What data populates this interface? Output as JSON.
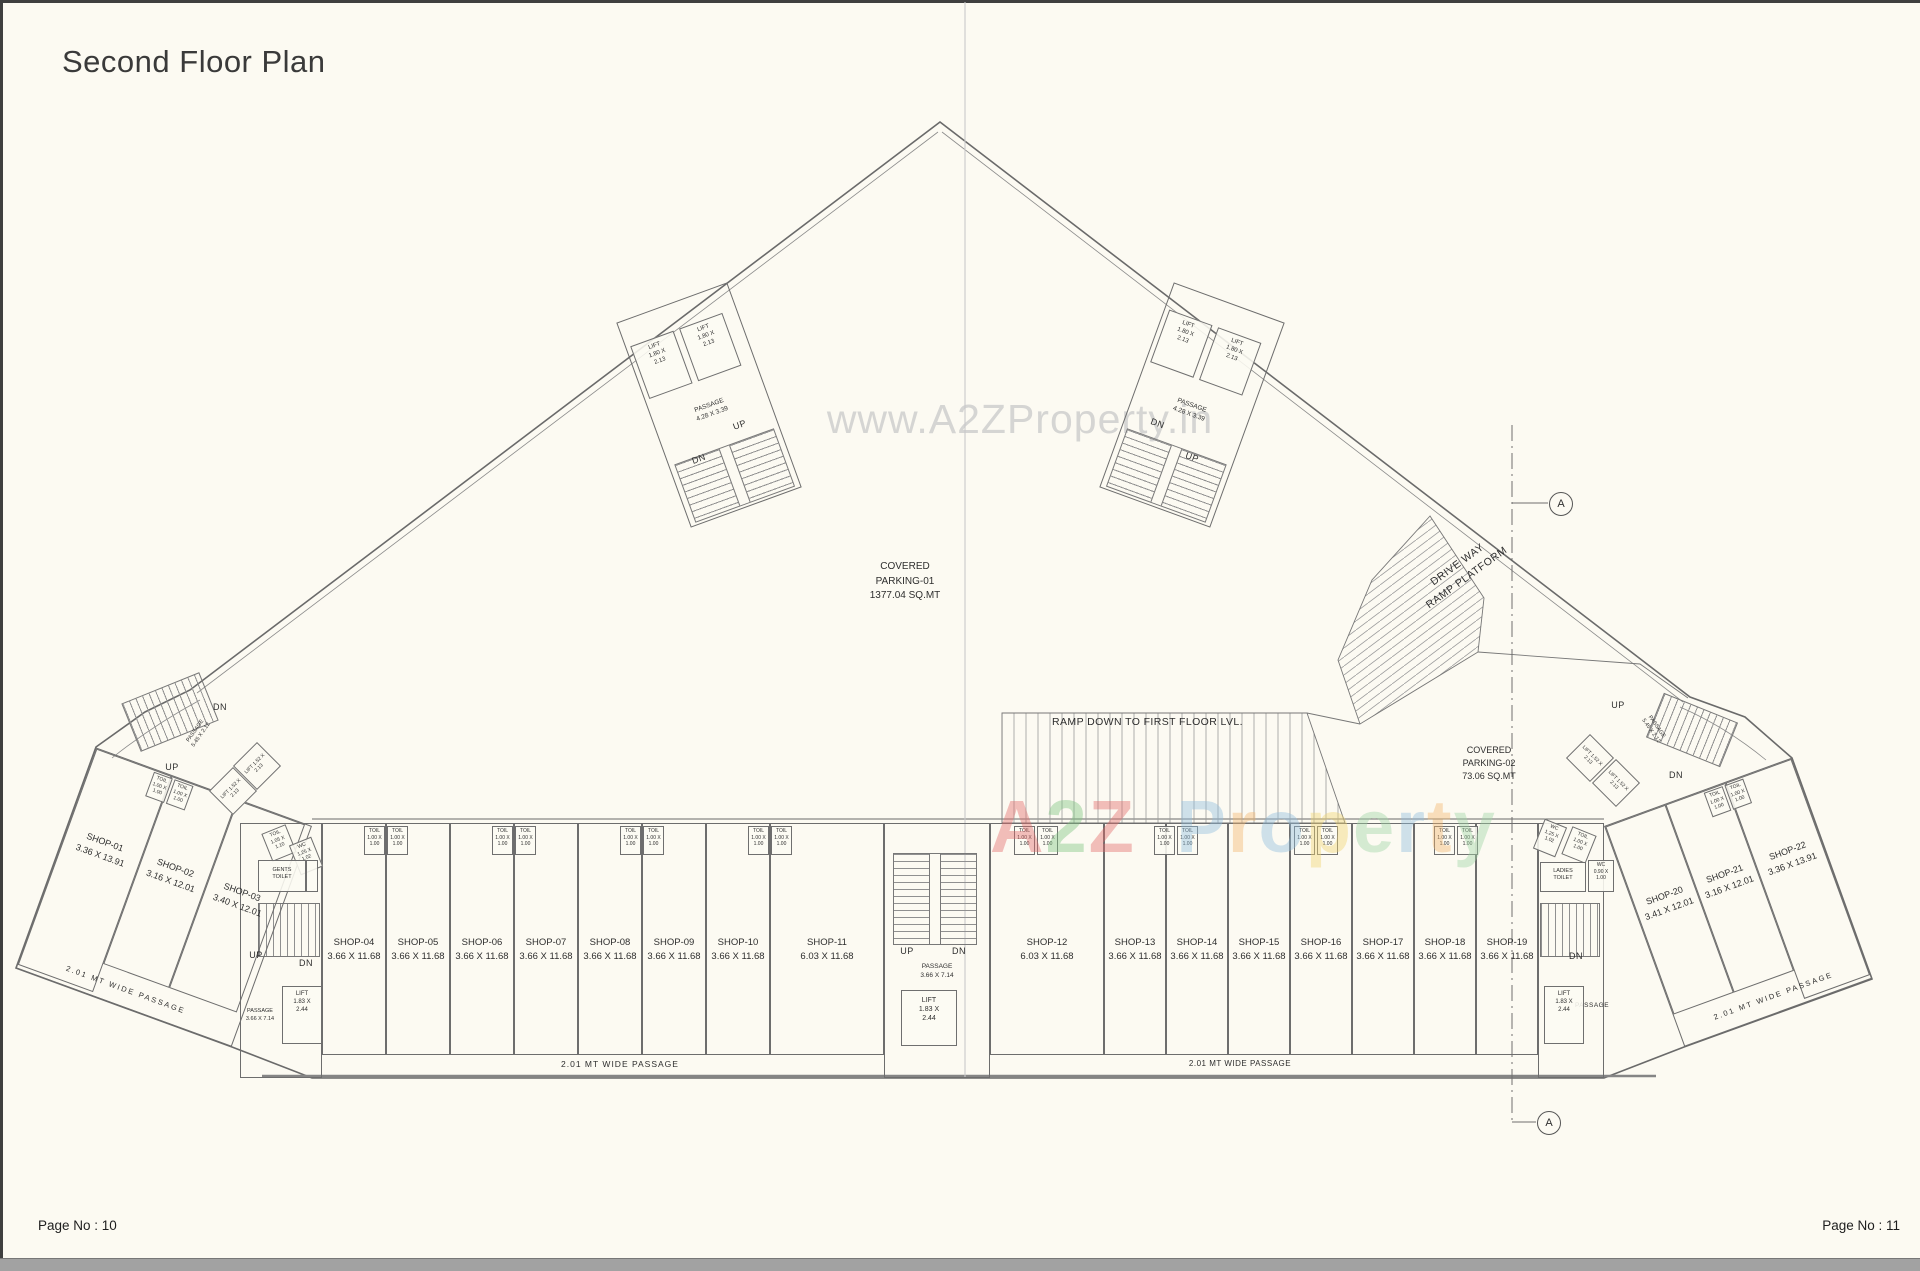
{
  "page": {
    "title": "Second Floor Plan",
    "page_no_left": "Page No : 10",
    "page_no_right": "Page No : 11"
  },
  "watermark": {
    "url": "www.A2ZProperty.in",
    "brand": "A2Z Property",
    "brand_letters": [
      [
        "A",
        "#e46a6a"
      ],
      [
        "2",
        "#7cc47f"
      ],
      [
        "Z",
        "#e46a6a"
      ],
      [
        " ",
        ""
      ],
      [
        "P",
        "#8fbede"
      ],
      [
        "r",
        "#f3b66e"
      ],
      [
        "o",
        "#8fbede"
      ],
      [
        "p",
        "#f2d571"
      ],
      [
        "e",
        "#9fd6a4"
      ],
      [
        "r",
        "#8fbede"
      ],
      [
        "t",
        "#f3b66e"
      ],
      [
        "y",
        "#9fd6a4"
      ]
    ]
  },
  "areas": {
    "parking1": [
      "COVERED",
      "PARKING-01",
      "1377.04 SQ.MT"
    ],
    "parking2": [
      "COVERED",
      "PARKING-02",
      "73.06 SQ.MT"
    ],
    "ramp_down": "RAMP DOWN TO FIRST FLOOR LVL.",
    "driveway": [
      "DRIVE WAY",
      "RAMP PLATFORM"
    ]
  },
  "shops": [
    {
      "id": "SHOP-01",
      "dim": "3.36 X 13.91"
    },
    {
      "id": "SHOP-02",
      "dim": "3.16 X 12.01"
    },
    {
      "id": "SHOP-03",
      "dim": "3.40 X 12.01"
    },
    {
      "id": "SHOP-04",
      "dim": "3.66 X 11.68"
    },
    {
      "id": "SHOP-05",
      "dim": "3.66 X 11.68"
    },
    {
      "id": "SHOP-06",
      "dim": "3.66 X 11.68"
    },
    {
      "id": "SHOP-07",
      "dim": "3.66 X 11.68"
    },
    {
      "id": "SHOP-08",
      "dim": "3.66 X 11.68"
    },
    {
      "id": "SHOP-09",
      "dim": "3.66 X 11.68"
    },
    {
      "id": "SHOP-10",
      "dim": "3.66 X 11.68"
    },
    {
      "id": "SHOP-11",
      "dim": "6.03 X 11.68"
    },
    {
      "id": "SHOP-12",
      "dim": "6.03 X 11.68"
    },
    {
      "id": "SHOP-13",
      "dim": "3.66 X 11.68"
    },
    {
      "id": "SHOP-14",
      "dim": "3.66 X 11.68"
    },
    {
      "id": "SHOP-15",
      "dim": "3.66 X 11.68"
    },
    {
      "id": "SHOP-16",
      "dim": "3.66 X 11.68"
    },
    {
      "id": "SHOP-17",
      "dim": "3.66 X 11.68"
    },
    {
      "id": "SHOP-18",
      "dim": "3.66 X 11.68"
    },
    {
      "id": "SHOP-19",
      "dim": "3.66 X 11.68"
    },
    {
      "id": "SHOP-20",
      "dim": "3.41 X 12.01"
    },
    {
      "id": "SHOP-21",
      "dim": "3.16 X 12.01"
    },
    {
      "id": "SHOP-22",
      "dim": "3.36 X 13.91"
    }
  ],
  "labels": {
    "up": "UP",
    "dn": "DN",
    "passage": "PASSAGE",
    "passage_wide": "2.01 MT WIDE PASSAGE",
    "section_marker": "A"
  },
  "boxes": {
    "lift_top": [
      "LIFT",
      "1.80 X",
      "2.13"
    ],
    "lift_small": [
      "LIFT",
      "1.52 X",
      "2.13"
    ],
    "lift_core": [
      "LIFT",
      "1.83 X",
      "2.44"
    ],
    "toil": [
      "TOIL",
      "1.00 X",
      "1.00"
    ],
    "toil_left": [
      "TOIL",
      "1.05 X",
      "1.10"
    ],
    "wc": [
      "WC",
      "1.25 X",
      "1.02"
    ],
    "wc_small": [
      "WC",
      "0.90 X",
      "1.00"
    ],
    "gents": [
      "GENTS",
      "TOILET"
    ],
    "ladies": [
      "LADIES",
      "TOILET"
    ],
    "passage_top": [
      "PASSAGE",
      "4.28 X 3.39"
    ],
    "passage_mid": [
      "PASSAGE",
      "3.66 X 7.14"
    ],
    "passage_arc": [
      "PASSAGE",
      "5.45 X 2.12"
    ]
  }
}
